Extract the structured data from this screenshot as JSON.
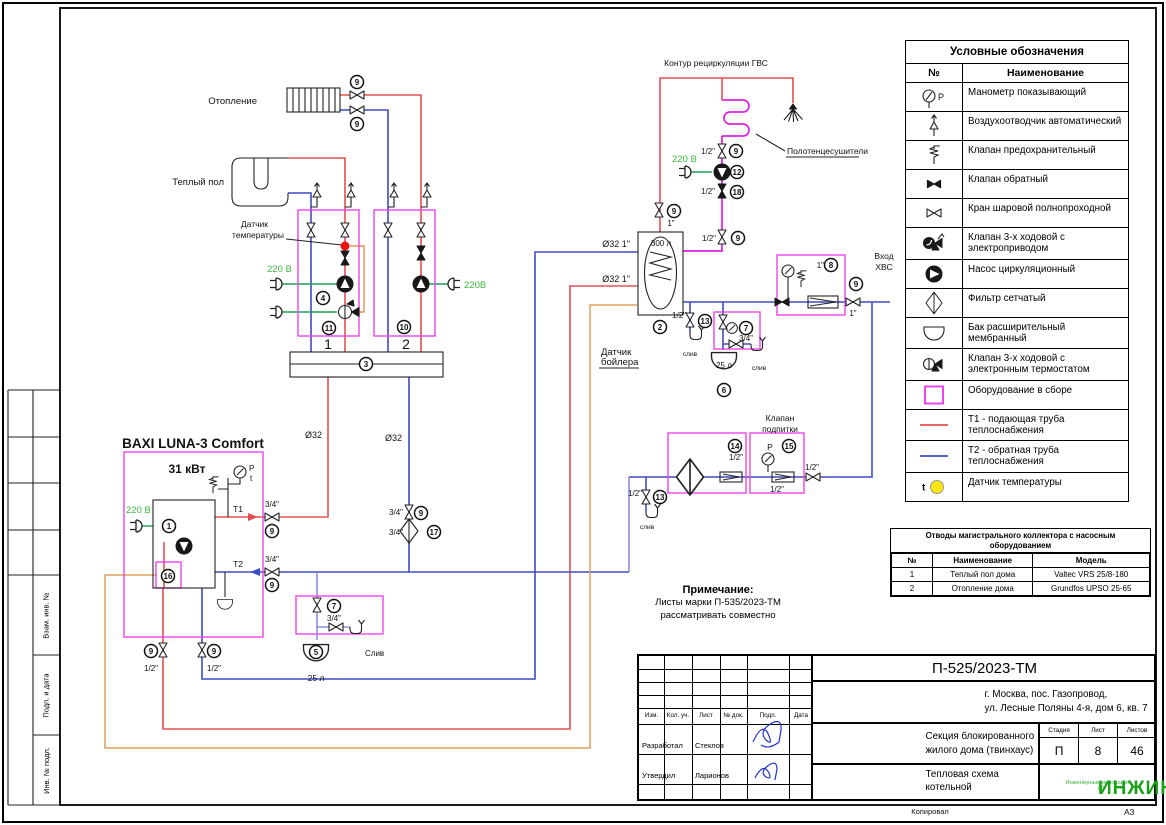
{
  "page": {
    "copied_label": "Копировал",
    "format_label": "А3"
  },
  "side_strip": {
    "labels": [
      "Взам. инв. №",
      "Подп. и дата",
      "Инв. № подл."
    ]
  },
  "legend": {
    "title": "Условные обозначения",
    "col_no": "№",
    "col_name": "Наименование",
    "rows": [
      {
        "icon": "manometer",
        "name": "Манометр показывающий"
      },
      {
        "icon": "airvent",
        "name": "Воздухоотводчик автоматический"
      },
      {
        "icon": "safety",
        "name": "Клапан предохранительный"
      },
      {
        "icon": "check",
        "name": "Клапан обратный"
      },
      {
        "icon": "ball",
        "name": "Кран шаровой полнопроходной"
      },
      {
        "icon": "threeway-el",
        "name": "Клапан 3-х ходовой с электроприводом"
      },
      {
        "icon": "pump",
        "name": "Насос циркуляционный"
      },
      {
        "icon": "filter",
        "name": "Фильтр сетчатый"
      },
      {
        "icon": "exptank",
        "name": "Бак расширительный мембранный"
      },
      {
        "icon": "threeway-th",
        "name": "Клапан 3-х ходовой с электронным термостатом"
      },
      {
        "icon": "assembly",
        "name": "Оборудование в сборе"
      },
      {
        "icon": "t1-line",
        "name": "Т1 - подающая труба теплоснабжения"
      },
      {
        "icon": "t2-line",
        "name": "Т2 - обратная труба теплоснабжения"
      },
      {
        "icon": "tsensor",
        "name": "Датчик температуры"
      }
    ]
  },
  "collector_table": {
    "title_line1": "Отводы магистрального коллектора с насосным",
    "title_line2": "оборудованием",
    "headers": [
      "№",
      "Наименование",
      "Модель"
    ],
    "rows": [
      [
        "1",
        "Теплый пол дома",
        "Valtec VRS 25/8-180"
      ],
      [
        "2",
        "Отопление дома",
        "Grundfos UPSO 25-65"
      ]
    ]
  },
  "title_block": {
    "doc_number": "П-525/2023-ТМ",
    "address_line1": "г. Москва, пос. Газопровод,",
    "address_line2": "ул. Лесные Поляны 4-я, дом 6, кв. 7",
    "object_line1": "Секция блокированного",
    "object_line2": "жилого дома (твинхаус)",
    "sheet_name_line1": "Тепловая схема",
    "sheet_name_line2": "котельной",
    "stage_label": "Стадия",
    "sheet_label": "Лист",
    "sheets_label": "Листов",
    "stage": "П",
    "sheet": "8",
    "sheets": "46",
    "header_cells": [
      "Изм.",
      "Кол. уч.",
      "Лист",
      "№ док.",
      "Подп.",
      "Дата"
    ],
    "developed_label": "Разработал",
    "developed_by": "Стеклов",
    "approved_label": "Утвердил",
    "approved_by": "Ларионов",
    "logo_text": "ИНЖИН",
    "logo_reg": "®",
    "logo_subtitle": "Инженерные инновации"
  },
  "note": {
    "title": "Примечание:",
    "line1": "Листы марки П-535/2023-ТМ",
    "line2": "рассматривать совместно"
  },
  "diagram": {
    "colors": {
      "t1_supply_red": "#e25050",
      "t2_return_blue": "#3f4cc2",
      "assembly_box_magenta": "#ee44ee",
      "recirculation_magenta": "#e020e0",
      "power_green": "#1f9e53",
      "power_label_green": "#3cbb3c",
      "sensor_cable_orange": "#dfa05e",
      "temp_sensor_dot_red": "#ee1111",
      "legend_sensor_yellow": "#ffe60a"
    },
    "labels": [
      {
        "t": "Отопление",
        "x": 257,
        "y": 104,
        "a": "e",
        "c": "lbl"
      },
      {
        "t": "Теплый пол",
        "x": 224,
        "y": 185,
        "a": "e",
        "c": "lbl"
      },
      {
        "t": "Датчик",
        "x": 268,
        "y": 227,
        "a": "e",
        "c": "sm"
      },
      {
        "t": "температуры",
        "x": 284,
        "y": 238,
        "a": "e",
        "c": "sm"
      },
      {
        "t": "220 В",
        "x": 267,
        "y": 272,
        "a": "s",
        "c": "green"
      },
      {
        "t": "220В",
        "x": 464,
        "y": 288,
        "a": "s",
        "c": "green"
      },
      {
        "t": "220 В",
        "x": 672,
        "y": 162,
        "a": "s",
        "c": "green"
      },
      {
        "t": "220 В",
        "x": 126,
        "y": 513,
        "a": "s",
        "c": "green"
      },
      {
        "t": "BAXI LUNA-3 Comfort",
        "x": 193,
        "y": 448,
        "a": "m",
        "c": "big"
      },
      {
        "t": "31 кВт",
        "x": 187,
        "y": 473,
        "a": "m",
        "c": "big2"
      },
      {
        "t": "T1",
        "x": 243,
        "y": 512,
        "a": "e",
        "c": "sm"
      },
      {
        "t": "T2",
        "x": 243,
        "y": 567,
        "a": "e",
        "c": "sm"
      },
      {
        "t": "Контур рециркуляции ГВС",
        "x": 716,
        "y": 66,
        "a": "m",
        "c": "sm"
      },
      {
        "t": "Полотенцесушители",
        "x": 787,
        "y": 154,
        "a": "s",
        "c": "sm"
      },
      {
        "t": "Вход",
        "x": 884,
        "y": 259,
        "a": "m",
        "c": "sm"
      },
      {
        "t": "ХВС",
        "x": 884,
        "y": 270,
        "a": "m",
        "c": "sm"
      },
      {
        "t": "300 л",
        "x": 661,
        "y": 246,
        "a": "m",
        "c": "sz"
      },
      {
        "t": "Датчик",
        "x": 601,
        "y": 355,
        "a": "s",
        "c": "lbl"
      },
      {
        "t": "бойлера",
        "x": 601,
        "y": 365,
        "a": "s",
        "c": "lbl"
      },
      {
        "t": "Клапан",
        "x": 780,
        "y": 421,
        "a": "m",
        "c": "sm"
      },
      {
        "t": "подпитки",
        "x": 780,
        "y": 432,
        "a": "m",
        "c": "sm"
      },
      {
        "t": "25 л",
        "x": 316,
        "y": 681,
        "a": "m",
        "c": "sm"
      },
      {
        "t": "25 л",
        "x": 724,
        "y": 368,
        "a": "m",
        "c": "sz"
      },
      {
        "t": "1",
        "x": 328,
        "y": 349,
        "a": "m",
        "c": "num"
      },
      {
        "t": "2",
        "x": 406,
        "y": 349,
        "a": "m",
        "c": "num"
      },
      {
        "t": "P",
        "x": 249,
        "y": 471,
        "a": "s",
        "c": "sz"
      },
      {
        "t": "t",
        "x": 250,
        "y": 481,
        "a": "s",
        "c": "sz"
      },
      {
        "t": "P",
        "x": 770,
        "y": 450,
        "a": "m",
        "c": "sm"
      },
      {
        "t": "3/4\"",
        "x": 272,
        "y": 507,
        "a": "m",
        "c": "sz"
      },
      {
        "t": "3/4\"",
        "x": 272,
        "y": 562,
        "a": "m",
        "c": "sz"
      },
      {
        "t": "1/2\"",
        "x": 151,
        "y": 671,
        "a": "m",
        "c": "sz"
      },
      {
        "t": "1/2\"",
        "x": 214,
        "y": 671,
        "a": "m",
        "c": "sz"
      },
      {
        "t": "Ø32",
        "x": 322,
        "y": 438,
        "a": "e",
        "c": "sz9"
      },
      {
        "t": "Ø32",
        "x": 402,
        "y": 441,
        "a": "e",
        "c": "sz9"
      },
      {
        "t": "Ø32  1\"",
        "x": 630,
        "y": 247,
        "a": "e",
        "c": "sz9"
      },
      {
        "t": "Ø32  1\"",
        "x": 630,
        "y": 282,
        "a": "e",
        "c": "sz9"
      },
      {
        "t": "3/4\"",
        "x": 403,
        "y": 515,
        "a": "e",
        "c": "sz"
      },
      {
        "t": "3/4\"",
        "x": 403,
        "y": 535,
        "a": "e",
        "c": "sz"
      },
      {
        "t": "1\"",
        "x": 671,
        "y": 226,
        "a": "m",
        "c": "sz"
      },
      {
        "t": "1\"",
        "x": 824,
        "y": 268,
        "a": "e",
        "c": "sz"
      },
      {
        "t": "1\"",
        "x": 853,
        "y": 316,
        "a": "m",
        "c": "sz"
      },
      {
        "t": "1/2\"",
        "x": 715,
        "y": 154,
        "a": "e",
        "c": "sz"
      },
      {
        "t": "1/2\"",
        "x": 715,
        "y": 194,
        "a": "e",
        "c": "sz"
      },
      {
        "t": "1/2\"",
        "x": 716,
        "y": 241,
        "a": "e",
        "c": "sz"
      },
      {
        "t": "1/2\"",
        "x": 686,
        "y": 318,
        "a": "e",
        "c": "sz"
      },
      {
        "t": "3/4\"",
        "x": 746,
        "y": 341,
        "a": "m",
        "c": "sz"
      },
      {
        "t": "1/2\"",
        "x": 736,
        "y": 460,
        "a": "m",
        "c": "sz"
      },
      {
        "t": "1/2\"",
        "x": 777,
        "y": 492,
        "a": "m",
        "c": "sz"
      },
      {
        "t": "1/2\"",
        "x": 812,
        "y": 470,
        "a": "m",
        "c": "sz"
      },
      {
        "t": "1/2\"",
        "x": 642,
        "y": 496,
        "a": "e",
        "c": "sz"
      },
      {
        "t": "3/4\"",
        "x": 334,
        "y": 621,
        "a": "m",
        "c": "sz"
      },
      {
        "t": "Слив",
        "x": 365,
        "y": 656,
        "a": "s",
        "c": "sz"
      },
      {
        "t": "слив",
        "x": 690,
        "y": 356,
        "a": "m",
        "c": "szt"
      },
      {
        "t": "слив",
        "x": 759,
        "y": 370,
        "a": "m",
        "c": "szt"
      },
      {
        "t": "слив",
        "x": 647,
        "y": 529,
        "a": "m",
        "c": "szt"
      }
    ],
    "tags": [
      {
        "n": "9",
        "x": 357,
        "y": 82
      },
      {
        "n": "9",
        "x": 357,
        "y": 124
      },
      {
        "n": "4",
        "x": 323,
        "y": 298
      },
      {
        "n": "11",
        "x": 329,
        "y": 328
      },
      {
        "n": "10",
        "x": 404,
        "y": 327
      },
      {
        "n": "3",
        "x": 366,
        "y": 364
      },
      {
        "n": "9",
        "x": 272,
        "y": 531
      },
      {
        "n": "9",
        "x": 272,
        "y": 585
      },
      {
        "n": "1",
        "x": 169,
        "y": 526
      },
      {
        "n": "16",
        "x": 168,
        "y": 576
      },
      {
        "n": "9",
        "x": 151,
        "y": 651
      },
      {
        "n": "9",
        "x": 214,
        "y": 651
      },
      {
        "n": "7",
        "x": 334,
        "y": 606
      },
      {
        "n": "5",
        "x": 316,
        "y": 652
      },
      {
        "n": "9",
        "x": 421,
        "y": 513
      },
      {
        "n": "17",
        "x": 434,
        "y": 532
      },
      {
        "n": "9",
        "x": 674,
        "y": 211
      },
      {
        "n": "2",
        "x": 660,
        "y": 327
      },
      {
        "n": "9",
        "x": 736,
        "y": 151
      },
      {
        "n": "12",
        "x": 737,
        "y": 172
      },
      {
        "n": "18",
        "x": 737,
        "y": 192
      },
      {
        "n": "9",
        "x": 738,
        "y": 238
      },
      {
        "n": "13",
        "x": 705,
        "y": 321
      },
      {
        "n": "7",
        "x": 746,
        "y": 328
      },
      {
        "n": "6",
        "x": 724,
        "y": 390
      },
      {
        "n": "8",
        "x": 831,
        "y": 265
      },
      {
        "n": "9",
        "x": 856,
        "y": 284
      },
      {
        "n": "14",
        "x": 735,
        "y": 446
      },
      {
        "n": "15",
        "x": 789,
        "y": 446
      },
      {
        "n": "13",
        "x": 660,
        "y": 497
      }
    ]
  }
}
